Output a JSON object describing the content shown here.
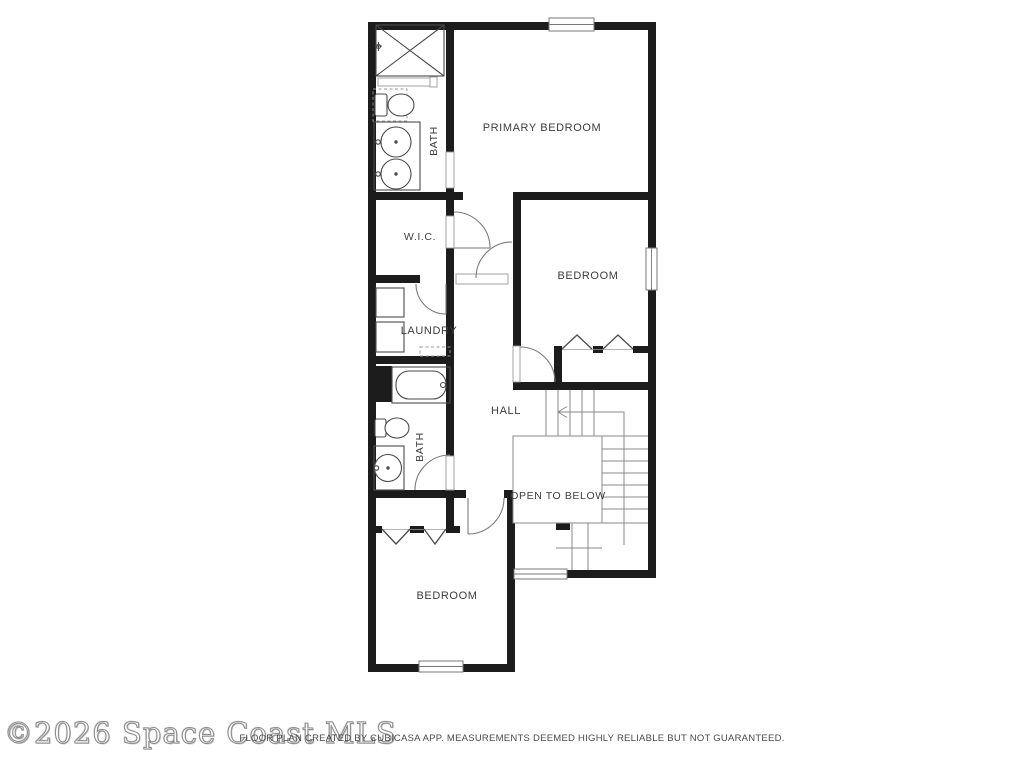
{
  "floor_plan": {
    "labels": {
      "primary_bedroom": "PRIMARY BEDROOM",
      "bath_top": "BATH",
      "wic": "W.I.C.",
      "bedroom_middle": "BEDROOM",
      "laundry": "LAUNDRY",
      "bath_lower": "BATH",
      "hall": "HALL",
      "open_to_below": "OPEN TO BELOW",
      "bedroom_bottom": "BEDROOM"
    },
    "colors": {
      "wall": "#1c1c1c",
      "fixture_line": "#4a4a4a",
      "label_text": "#3d3d3d",
      "background": "#ffffff"
    }
  },
  "footer": {
    "watermark": "©2026 Space Coast MLS",
    "disclaimer": "FLOOR PLAN CREATED BY CUBICASA APP. MEASUREMENTS DEEMED HIGHLY RELIABLE BUT NOT GUARANTEED."
  }
}
